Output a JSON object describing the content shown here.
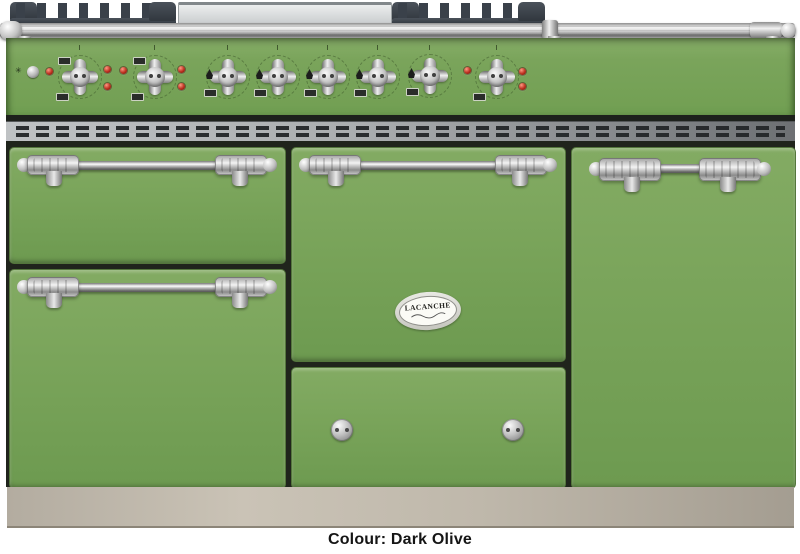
{
  "caption": "Colour: Dark Olive",
  "badge": {
    "brand": "LACANCHE"
  },
  "colors": {
    "body_green": "#77a258",
    "panel_green": "#7aa45b",
    "gap_dark": "#20241c",
    "plinth_beige": "#bfb8ab",
    "indicator_red": "#bb2f1f",
    "grate_dark": "#3a414a",
    "steel_plate": "#d9dbdc",
    "background": "#ffffff"
  },
  "controls": {
    "knobs": [
      {
        "id": "left-oven-knob-1",
        "type": "oven-thermostat"
      },
      {
        "id": "left-oven-knob-2",
        "type": "oven-thermostat"
      },
      {
        "id": "burner-knob-1",
        "type": "gas-burner"
      },
      {
        "id": "burner-knob-2",
        "type": "gas-burner"
      },
      {
        "id": "burner-knob-3",
        "type": "gas-burner"
      },
      {
        "id": "burner-knob-4",
        "type": "gas-burner"
      },
      {
        "id": "burner-knob-5",
        "type": "gas-burner"
      },
      {
        "id": "right-oven-knob",
        "type": "oven-thermostat"
      }
    ],
    "indicator_light_count": 9
  }
}
